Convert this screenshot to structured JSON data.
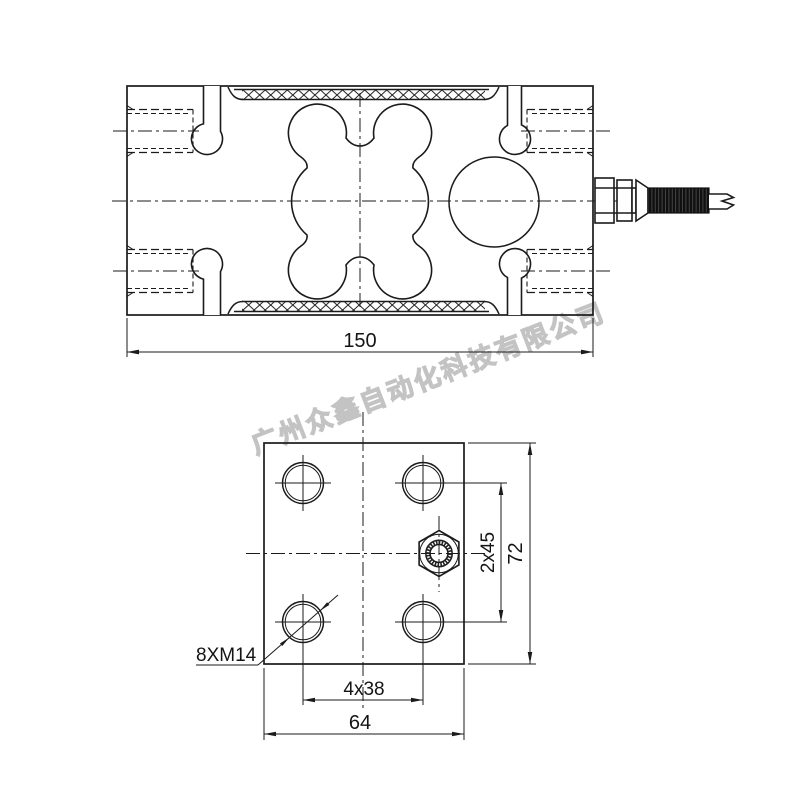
{
  "watermark": {
    "text": "广州众鑫自动化科技有限公司",
    "color": "#c3c3c3"
  },
  "drawing": {
    "type": "load-cell engineering drawing, two orthographic views",
    "views": {
      "side_view": "load cell body with binocular spring-element cutout and cable gland",
      "end_view": "mounting plate face with four bolt holes and cable gland nut"
    }
  },
  "dimensions": {
    "overall_length": "150",
    "plate_width": "64",
    "plate_height": "72",
    "hole_spacing_horizontal": "4x38",
    "hole_spacing_vertical": "2x45",
    "thread_callout": "8XM14"
  },
  "colors": {
    "line": "#1b1b1b",
    "background": "#ffffff",
    "watermark": "#c3c3c3"
  }
}
